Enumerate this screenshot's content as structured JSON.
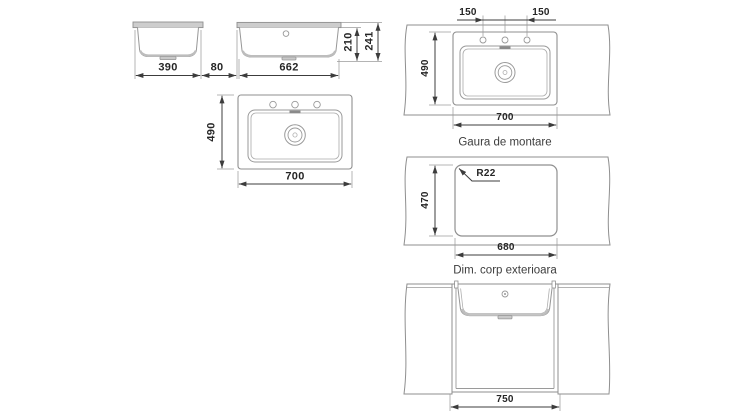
{
  "colors": {
    "background": "#ffffff",
    "outline": "#8f8f8f",
    "dimension_line": "#3c3c3c",
    "text": "#262626",
    "rim_fill": "#cdcdcd"
  },
  "labels": {
    "side_width": "390",
    "edge_offset": "80",
    "front_width": "662",
    "bowl_depth": "210",
    "overall_height": "241",
    "plan_depth": "490",
    "plan_width": "700",
    "tap_spacing_left": "150",
    "tap_spacing_right": "150",
    "mount_depth": "490",
    "mount_width": "700",
    "mount_caption": "Gaura de montare",
    "corner_radius": "R22",
    "cutout_depth": "470",
    "cutout_width": "680",
    "cutout_caption": "Dim. corp exterioara",
    "cabinet_width": "750"
  }
}
